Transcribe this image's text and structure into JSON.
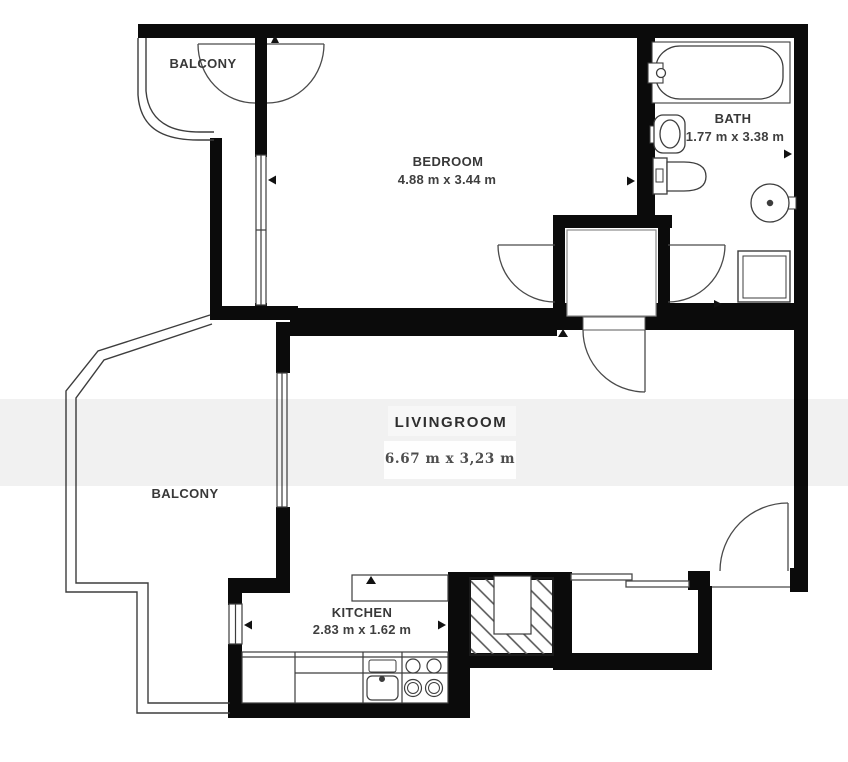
{
  "plan_title": "Apartment floor plan",
  "rooms": [
    {
      "id": "balcony-top",
      "name": "BALCONY",
      "dimensions": ""
    },
    {
      "id": "bedroom",
      "name": "BEDROOM",
      "dimensions": "4.88 m x 3.44 m"
    },
    {
      "id": "bath",
      "name": "BATH",
      "dimensions": "1.77 m x 3.38 m"
    },
    {
      "id": "livingroom",
      "name": "LIVINGROOM",
      "dimensions": "6.67 m x 3,23 m"
    },
    {
      "id": "balcony-left",
      "name": "BALCONY",
      "dimensions": ""
    },
    {
      "id": "kitchen",
      "name": "KITCHEN",
      "dimensions": "2.83 m x 1.62 m"
    }
  ],
  "fixtures": [
    "bathtub",
    "washbasin",
    "toilet",
    "boiler",
    "shower-cabinet",
    "kitchen-counter",
    "kitchen-sink",
    "stove",
    "upper-cabinet",
    "ventilation-shaft",
    "sliding-door",
    "entrance-door"
  ],
  "colors": {
    "wall": "#0b0b0b",
    "thin_line": "#3d3d3d",
    "label": "#383838",
    "artifact_band": "rgba(0,0,0,0.055)"
  }
}
